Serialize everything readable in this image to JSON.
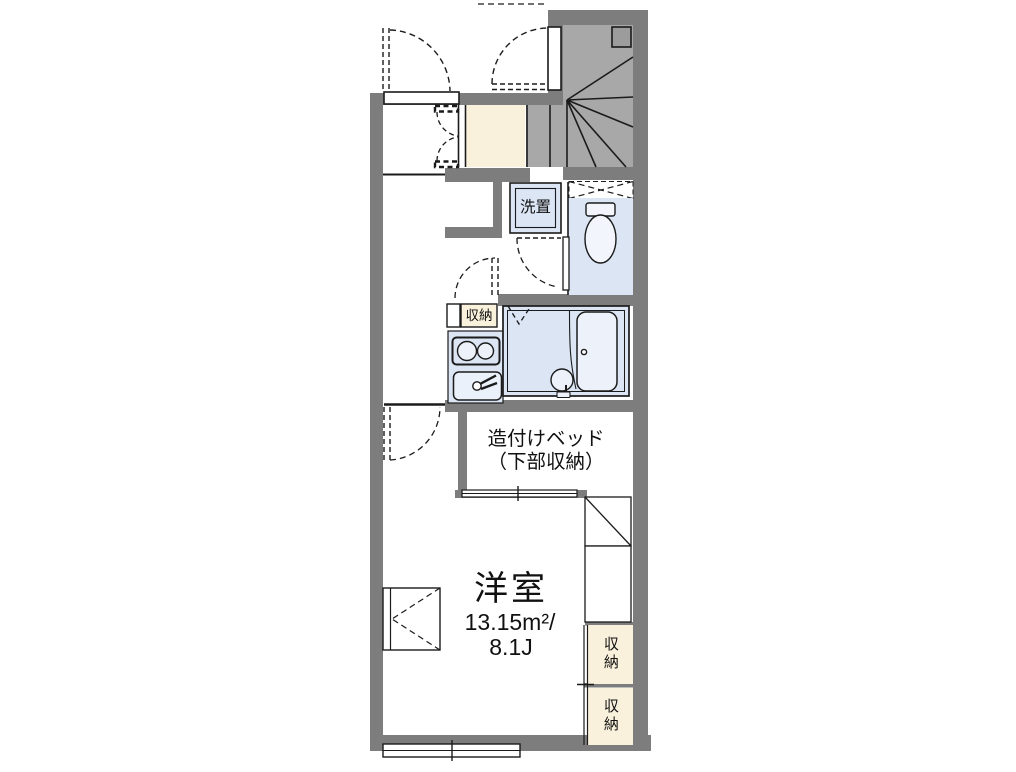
{
  "plan": {
    "rooms": {
      "main_room": {
        "name": "洋室",
        "area_sqm": "13.15m²/",
        "area_tatami": "8.1J"
      },
      "built_in_bed": {
        "line1": "造付けベッド",
        "line2": "（下部収納）"
      },
      "washer_space": {
        "label": "洗置"
      },
      "hall_storage": {
        "label": "収納"
      },
      "right_storage_top": {
        "label": "収納"
      },
      "right_storage_bottom": {
        "label": "収納"
      }
    },
    "colors": {
      "wall": "#7D7D7D",
      "stairs_fill": "#A8A8A8",
      "wet_area_fill": "#DBE5F4",
      "fixture_fill": "#EDF2FA",
      "storage_fill": "#FAF1DC",
      "outline": "#1B1B1B",
      "background": "#FFFFFF"
    }
  }
}
